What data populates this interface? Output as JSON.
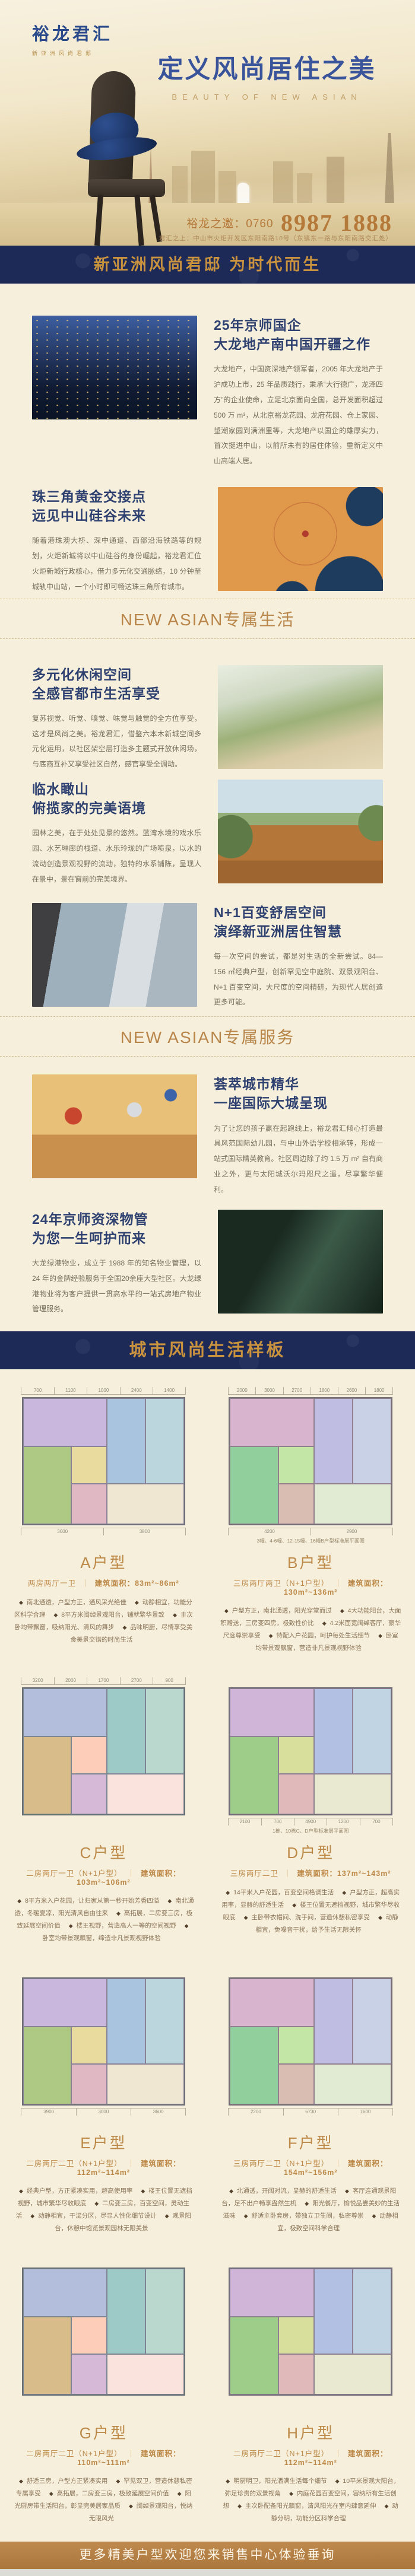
{
  "brand": {
    "logo": "裕龙君汇",
    "tagline": "新亚洲风尚君邸"
  },
  "hero": {
    "title": "定义风尚居住之美",
    "subtitle_en": "BEAUTY OF NEW ASIAN",
    "invite_label": "裕龙之邀：0760",
    "phone": "8987 1888",
    "address": "君汇之上：中山市火炬开发区东阳南路10号（东镇东一路与东阳南路交汇处）"
  },
  "banners": {
    "slogan": "新亚洲风尚君邸 为时代而生",
    "lifestyle": "城市风尚生活样板",
    "footer": "更多精美户型欢迎您来销售中心体验垂询"
  },
  "section_dividers": {
    "life": "NEW ASIAN专属生活",
    "service": "NEW ASIAN专属服务"
  },
  "colors": {
    "navy": "#1d2a58",
    "gold": "#c8923f",
    "bronze": "#b8854a",
    "cream": "#f6efdb"
  },
  "features": [
    {
      "heading1": "25年京师国企",
      "heading2": "大龙地产南中国开疆之作",
      "body": "大龙地产，中国资深地产领军者，2005 年大龙地产于沪成功上市，25 年品质践行，秉承“大行德广，龙泽四方”的企业使命，立足北京面向全国，总开发面积超过 500 万 m²，从北京裕龙花园、龙府花园、仓上家园、望潮家园到满洲里等，大龙地产以国企的雄厚实力，首次挺进中山，以前所未有的居住体验，重新定义中山高端人居。"
    },
    {
      "heading1": "珠三角黄金交接点",
      "heading2": "远见中山硅谷未来",
      "body": "随着港珠澳大桥、深中通道、西部沿海铁路等的规划，火炬新城将以中山硅谷的身份崛起，裕龙君汇位火炬新城行政核心，借力多元化交通脉络，10 分钟至城轨中山站，一个小时即可畅达珠三角所有城市。"
    },
    {
      "heading1": "多元化休闲空间",
      "heading2": "全感官都市生活享受",
      "body": "复苏视觉、听觉、嗅觉、味觉与触觉的全方位享受，这才是风尚之美。裕龙君汇，借鉴六本木新城空间多元化运用，以社区架空层打造多主题式开放休闲场，与底商互补又享受社区自然，感官享受全调动。"
    },
    {
      "heading1": "临水瞰山",
      "heading2": "俯揽家的完美语境",
      "body": "园林之美，在于处处见景的悠然。蓝湾水境的戏水乐园、水艺琳廊的栈道、水乐玲珑的广场喷泉，以水的流动创造景观视野的流动，独特的水系铺陈，呈现人在景中，景在窗前的完美境界。"
    },
    {
      "heading1": "N+1百变舒居空间",
      "heading2": "演绎新亚洲居住智慧",
      "body": "每一次空间的尝试，都是对生活的全新尝试。84—156 ㎡经典户型，创新罕见空中庭院、双景观阳台、N+1 百变空间，大尺度的空间精研，为现代人居创造更多可能。"
    },
    {
      "heading1": "荟萃城市精华",
      "heading2": "一座国际大城呈现",
      "body": "为了让您的孩子赢在起跑线上，裕龙君汇倾心打造最具风范国际幼儿园，与中山外语学校相承转，形成一站式国际精英教育。社区周边除了约 1.5 万 m² 自有商业之外，更与太阳城沃尔玛咫尺之遥，尽享繁华便利。"
    },
    {
      "heading1": "24年京师资深物管",
      "heading2": "为您一生呵护而来",
      "body": "大龙绿港物业，成立于 1988 年的知名物业管理，以 24 年的金牌经验服务于全国20余座大型社区。大龙绿港物业将为客户提供一贯高水平的一站式房地产物业管理服务。"
    }
  ],
  "floorplans": [
    {
      "name": "A户型",
      "layout": "两房两厅一卫",
      "area": "建筑面积：83m²~86m²",
      "bullets": [
        "南北通透，户型方正，通风采光绝佳",
        "动静相宜，功能分区科学合理",
        "8平方米阔绰景观阳台，铺就繁华景致",
        "主次卧均带飘窗，吸纳阳光、清风的舞步",
        "品味明厨，尽情享受美食美景交错的时尚生活"
      ],
      "dims_top": [
        "700",
        "1100",
        "1000",
        "2400",
        "1400"
      ],
      "dims_bottom": [
        "3600",
        "3800"
      ],
      "caption": ""
    },
    {
      "name": "B户型",
      "layout": "三房两厅两卫（N+1户型）",
      "area": "建筑面积：130m²~136m²",
      "bullets": [
        "户型方正，南北通透，阳光穿堂而过",
        "4大功能阳台，大面积赠送，三房变四房，极致性价比",
        "4.2米面宽阔绰客厅，豪华尺度尊崇享受",
        "特配入户花园，呵护每处生活细节",
        "卧室均带景观飘窗，营造非凡景观视野体验"
      ],
      "dims_top": [
        "2000",
        "3000",
        "2700",
        "1800",
        "2600",
        "1800"
      ],
      "dims_bottom": [
        "4200",
        "2900"
      ],
      "caption": "3幢、4-6幢、12-15幢、16幢B户型标准层平面图"
    },
    {
      "name": "C户型",
      "layout": "二房两厅一卫（N+1户型）",
      "area": "建筑面积：103m²~106m²",
      "bullets": [
        "8平方米入户花园，让归家从第一秒开始芳香四溢",
        "南北通透，冬暖夏凉，阳光清风自由往来",
        "高拓展，二房变三房，极致延展空间价值",
        "楼王视野，营造高人一等的空间视野",
        "卧室均带景观飘窗，缔造非凡景观视野体验"
      ],
      "dims_top": [
        "3200",
        "2000",
        "1700",
        "2700",
        "900"
      ],
      "dims_bottom": [],
      "caption": ""
    },
    {
      "name": "D户型",
      "layout": "三房两厅二卫",
      "area": "建筑面积：137m²~143m²",
      "bullets": [
        "14平米入户花园，百变空间格调生活",
        "户型方正，超高实用率，显赫的舒适生活",
        "楼王位置无遮挡视野，城市繁华尽收眼底",
        "主卧带衣帽间、洗手间，营造休憩私密享受",
        "动静相宜，免噪音干扰，给予生活无限关怀"
      ],
      "dims_top": [],
      "dims_bottom": [
        "2100",
        "700",
        "4900",
        "1200",
        "700"
      ],
      "caption": "1栋、10栋C、D户型标准层平面图"
    },
    {
      "name": "E户型",
      "layout": "二房两厅二卫（N+1户型）",
      "area": "建筑面积：112m²~114m²",
      "bullets": [
        "经典户型，方正紧凑实用，超高使用率",
        "楼王位置无遮挡视野，城市繁华尽收眼底",
        "二房变三房，百变空间，灵动生活",
        "动静相宜，干湿分区，尽显人性化细节设计",
        "观景阳台，休憩中饱览景观园林无限美景"
      ],
      "dims_top": [],
      "dims_bottom": [
        "3900",
        "3000",
        "3600"
      ],
      "caption": ""
    },
    {
      "name": "F户型",
      "layout": "三房两厅二卫（N+1户型）",
      "area": "建筑面积：154m²~156m²",
      "bullets": [
        "北通透，开阔对流，显赫的舒适生活",
        "客厅连通观景阳台，足不出户畅享盎然生机",
        "阳光餐厅，愉悦品尝美妙的生活滋味",
        "舒适主卧套房，带独立卫生间，私密尊崇",
        "动静相宜，极致空间科学合理"
      ],
      "dims_top": [],
      "dims_bottom": [
        "2200",
        "6730",
        "1600"
      ],
      "caption": ""
    },
    {
      "name": "G户型",
      "layout": "二房两厅二卫（N+1户型）",
      "area": "建筑面积：110m²~111m²",
      "bullets": [
        "舒适三房，户型方正紧凑实用",
        "罕见双卫，营造休憩私密专属享受",
        "高拓展，二房变三房，极致延展空间价值",
        "阳光厨房带生活阳台，彰显完美居家品质",
        "阔绰景观阳台，悦纳无限风光"
      ],
      "dims_top": [],
      "dims_bottom": [],
      "caption": ""
    },
    {
      "name": "H户型",
      "layout": "二房两厅二卫（N+1户型）",
      "area": "建筑面积：112m²~114m²",
      "bullets": [
        "明厨明卫，阳光洒满生活每个细节",
        "10平米景观大阳台，弥足珍贵的双景视角",
        "内庭花园百变空间，容纳所有生活创想",
        "主次卧配备阳光飘窗，清风阳光在室内肆意延伸",
        "动静分明，功能分区科学合理"
      ],
      "dims_top": [],
      "dims_bottom": [],
      "caption": ""
    }
  ]
}
